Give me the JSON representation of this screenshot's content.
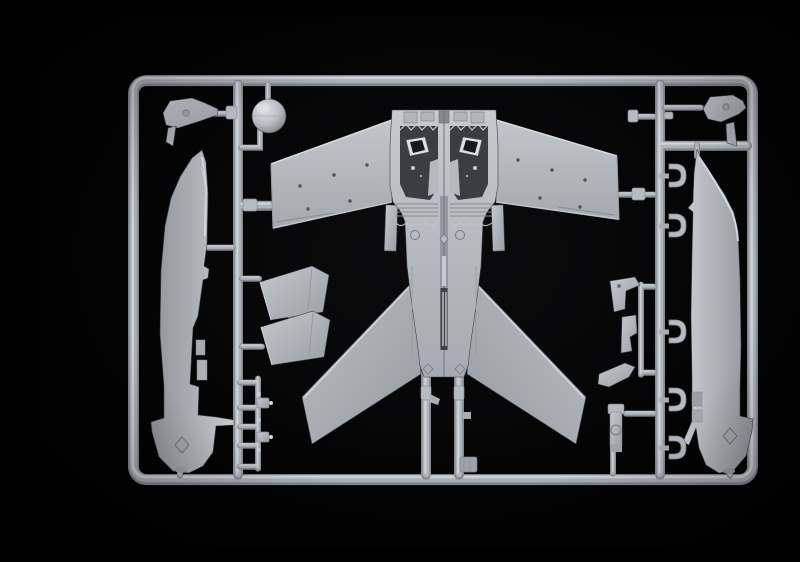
{
  "meta": {
    "description": "Macro photograph of a light grey injection-moulded plastic model kit sprue (runner frame) holding aircraft model parts, shot on a black background."
  },
  "palette": {
    "background": "#000000",
    "plastic_base": "#b4b8be",
    "plastic_highlight": "#d2d6da",
    "plastic_mid": "#a6aab1",
    "plastic_shadow": "#83878e",
    "recess_dark": "#3a3e44"
  },
  "sprue": {
    "frame_shape": "rounded rectangle runner frame with internal vertical and horizontal runners",
    "parts": [
      {
        "name": "center-wing-fuselage-section",
        "appearance": "one-piece centre section: both swept wings, twin dark cockpit recesses, ribbed spine, two outward-angled tail fins"
      },
      {
        "name": "fuselage-half-left",
        "appearance": "long tapered fuselage half with flared nose cone and engraved diamond mark, mounted vertically along the left side"
      },
      {
        "name": "fuselage-half-right",
        "appearance": "mirrored fuselage half with bright canopy-rail curve and flared nose cone, mounted vertically along the right side"
      },
      {
        "name": "nose-dome",
        "appearance": "hemispherical radome ball near the top left"
      },
      {
        "name": "windscreen-left",
        "appearance": "small angular windscreen/canopy piece at top left with hanging blade part"
      },
      {
        "name": "windscreen-right",
        "appearance": "small angular windscreen/canopy piece at top right with hanging blade part"
      },
      {
        "name": "intake-plates",
        "appearance": "two slanted quadrilateral plates stacked mid-left"
      },
      {
        "name": "small-parts-ladder",
        "appearance": "ladder-shaped runner with five rungs, two boxed fittings and tiny studs, lower left"
      },
      {
        "name": "hook-brackets",
        "appearance": "five C-shaped brackets spaced along the right vertical runner"
      },
      {
        "name": "landing-gear-parts",
        "appearance": "assorted small gear legs and brackets between the centre section and right runner"
      },
      {
        "name": "support-runners",
        "appearance": "two vertical feed runners from the tail of the centre section to the bottom rail, one with a square foot plate"
      }
    ]
  }
}
